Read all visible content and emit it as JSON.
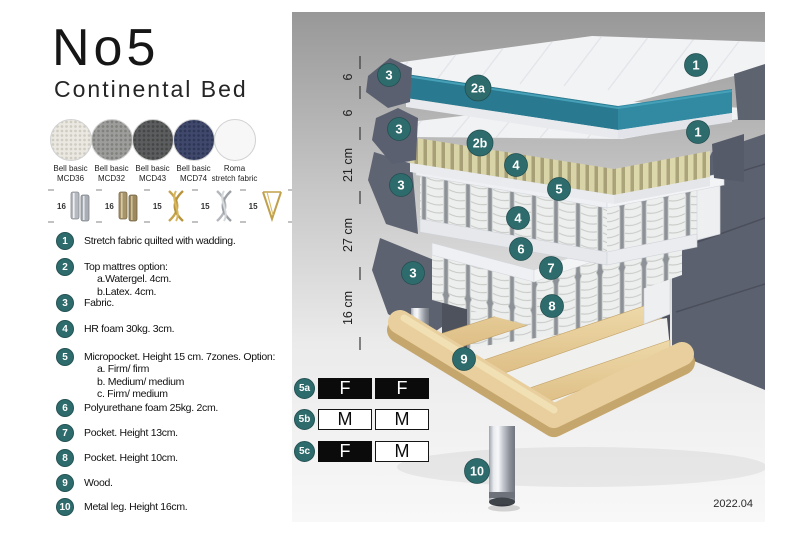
{
  "title": "No5",
  "subtitle": "Continental Bed",
  "swatches": [
    {
      "name": "Bell basic",
      "code": "MCD36",
      "color": "#eae8e1"
    },
    {
      "name": "Bell basic",
      "code": "MCD32",
      "color": "#9d9d9b"
    },
    {
      "name": "Bell basic",
      "code": "MCD43",
      "color": "#5b5d5e"
    },
    {
      "name": "Bell basic",
      "code": "MCD74",
      "color": "#40496c"
    },
    {
      "name": "Roma",
      "code": "stretch fabric",
      "color": "#f7f7f7"
    }
  ],
  "legs": [
    {
      "height": "16",
      "type": "cylinder-silver"
    },
    {
      "height": "16",
      "type": "cylinder-bronze"
    },
    {
      "height": "15",
      "type": "twisted-gold"
    },
    {
      "height": "15",
      "type": "twisted-silver"
    },
    {
      "height": "15",
      "type": "hairpin-gold"
    },
    {
      "height": "16",
      "type": "tapered-black-gold"
    }
  ],
  "spec_items": [
    {
      "num": "1",
      "lines": [
        "Stretch fabric quilted with wadding."
      ]
    },
    {
      "num": "2",
      "lines": [
        "Top mattres option:",
        "a.Watergel. 4cm.",
        "b.Latex. 4cm."
      ]
    },
    {
      "num": "3",
      "lines": [
        "Fabric."
      ]
    },
    {
      "num": "4",
      "lines": [
        "HR foam 30kg. 3cm."
      ]
    },
    {
      "num": "5",
      "lines": [
        "Micropocket. Height 15 cm. 7zones. Option:",
        "a. Firm/ firm",
        "b. Medium/ medium",
        "c. Firm/ medium"
      ]
    },
    {
      "num": "6",
      "lines": [
        "Polyurethane foam 25kg. 2cm."
      ]
    },
    {
      "num": "7",
      "lines": [
        "Pocket. Height 13cm."
      ]
    },
    {
      "num": "8",
      "lines": [
        "Pocket. Height 10cm."
      ]
    },
    {
      "num": "9",
      "lines": [
        "Wood."
      ]
    },
    {
      "num": "10",
      "lines": [
        "Metal leg. Height 16cm."
      ]
    }
  ],
  "diagram": {
    "ruler_labels": [
      "6",
      "6",
      "21 cm",
      "27 cm",
      "16 cm"
    ],
    "callouts": {
      "l3_top": "3",
      "l2a": "2a",
      "l1_top": "1",
      "l3_mid": "3",
      "l2b": "2b",
      "l1_mid": "1",
      "l4_top": "4",
      "l5": "5",
      "l3_springs": "3",
      "l4_bottom": "4",
      "l6": "6",
      "l7": "7",
      "l3_base": "3",
      "l8": "8",
      "l9": "9",
      "l10": "10"
    },
    "firmness": [
      {
        "id": "5a",
        "left": "F",
        "right": "F"
      },
      {
        "id": "5b",
        "left": "M",
        "right": "M"
      },
      {
        "id": "5c",
        "left": "F",
        "right": "M"
      }
    ],
    "version": "2022.04"
  },
  "colors": {
    "accent_teal": "#2e6b6d",
    "watergel_teal": "#2c7e93",
    "latex_tan": "#d8d2a6",
    "upholstery_gray": "#5e6370",
    "wood": "#e8cf9d"
  }
}
